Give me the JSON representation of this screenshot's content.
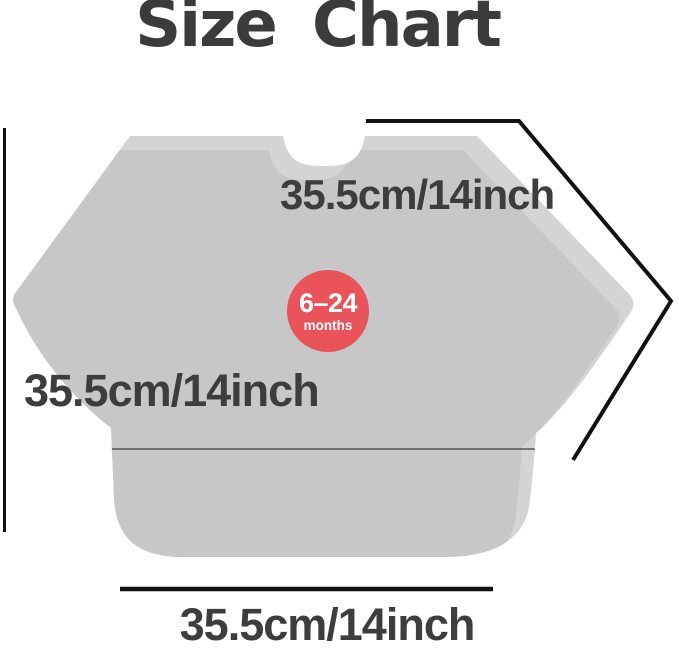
{
  "title": "Size Chart",
  "bib": {
    "badge": {
      "range": "6–24",
      "unit": "months"
    },
    "measurements": {
      "top_edge": "35.5cm/14inch",
      "width": "35.5cm/14inch",
      "bottom": "35.5cm/14inch"
    }
  },
  "colors": {
    "bib_light": "#d4d4d4",
    "bib_shade": "#c7c7c7",
    "pocket_line": "#555555",
    "measure_line": "#111111",
    "badge_red": "#e8545a",
    "text_dark": "#3d3d3d"
  }
}
